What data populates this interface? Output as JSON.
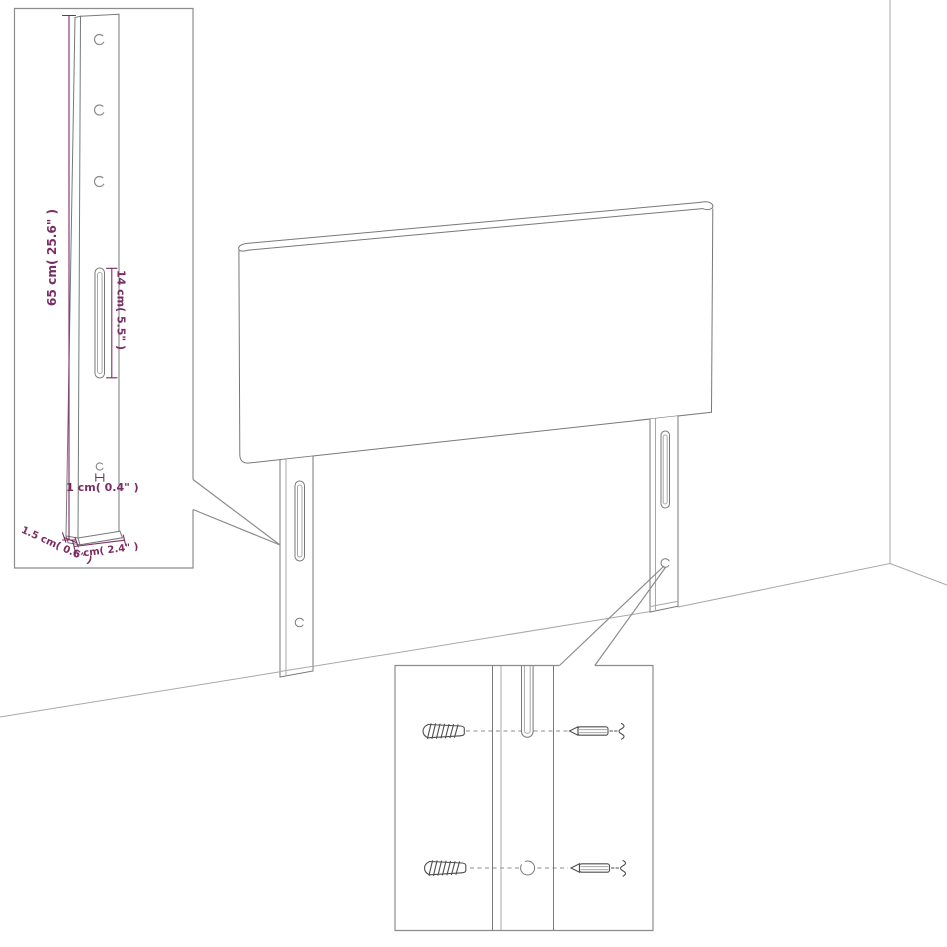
{
  "colors": {
    "accent_purple": "#7a2d63",
    "outline_gray": "#787878",
    "light_gray": "#a8a8a8",
    "border_gray": "#8c8c8c",
    "background": "#ffffff"
  },
  "inset_leg_detail": {
    "height_label": "65 cm( 25.6\" )",
    "slot_label": "14 cm( 5.5\" )",
    "hole_label": "1 cm( 0.4\" )",
    "thickness_label": "1.5 cm( 0.6\" )",
    "width_label": "6 cm( 2.4\" )"
  }
}
